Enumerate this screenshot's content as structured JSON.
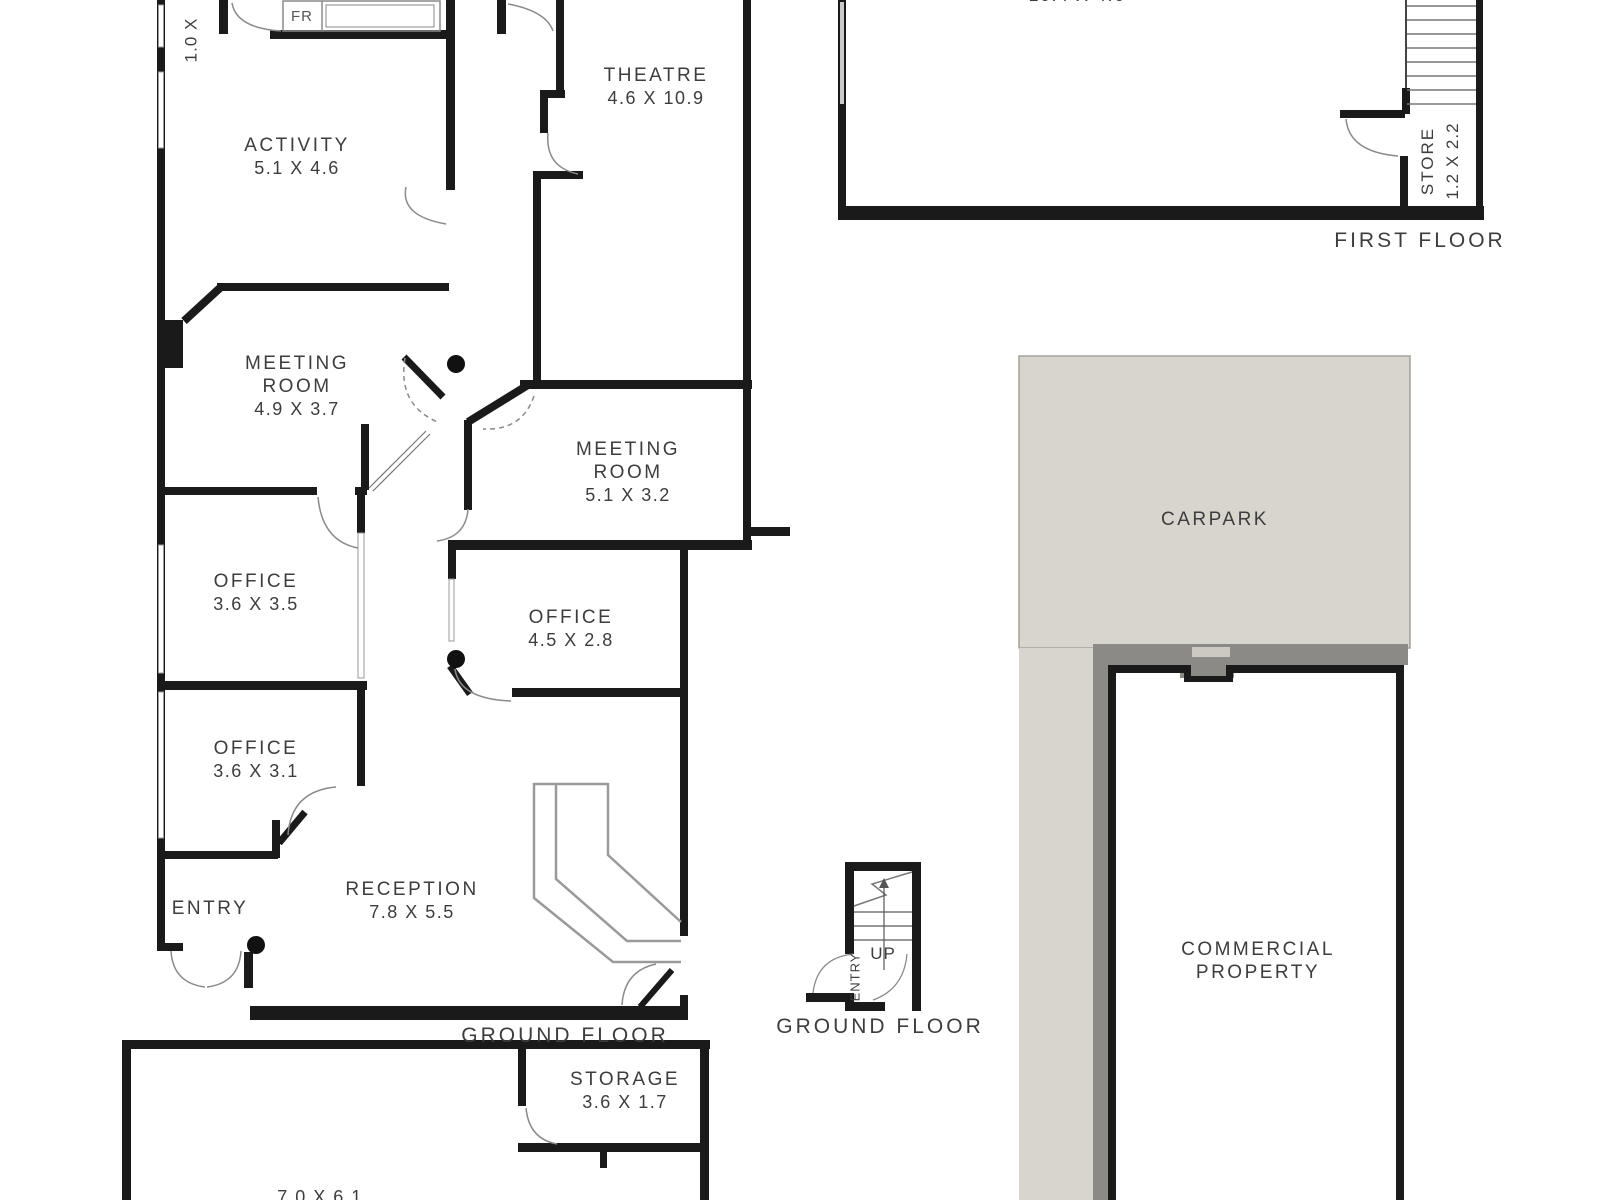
{
  "fp": {
    "ground": {
      "floor_label": "GROUND FLOOR",
      "rooms": {
        "activity": {
          "name": "ACTIVITY",
          "dims": "5.1 X 4.6"
        },
        "theatre": {
          "name": "THEATRE",
          "dims": "4.6 X 10.9"
        },
        "meeting1": {
          "name1": "MEETING",
          "name2": "ROOM",
          "dims": "4.9 X 3.7"
        },
        "meeting2": {
          "name1": "MEETING",
          "name2": "ROOM",
          "dims": "5.1 X 3.2"
        },
        "office1": {
          "name": "OFFICE",
          "dims": "3.6 X 3.5"
        },
        "office2": {
          "name": "OFFICE",
          "dims": "4.5 X 2.8"
        },
        "office3": {
          "name": "OFFICE",
          "dims": "3.6 X 3.1"
        },
        "reception": {
          "name": "RECEPTION",
          "dims": "7.8 X 5.5"
        },
        "entry": {
          "name": "ENTRY"
        },
        "small_room_dims_partial": "1.0 X",
        "fridge": "FR"
      }
    },
    "first": {
      "floor_label": "FIRST FLOOR",
      "room_dims_partial": "10.4 X 4.6",
      "store": {
        "name": "STORE",
        "dims": "1.2 X 2.2"
      }
    },
    "stairwell": {
      "up": "UP",
      "entry": "ENTRY",
      "floor_label": "GROUND FLOOR"
    },
    "site": {
      "carpark": "CARPARK",
      "commercial1": "COMMERCIAL",
      "commercial2": "PROPERTY"
    },
    "lower": {
      "storage": {
        "name": "STORAGE",
        "dims": "3.6 X 1.7"
      },
      "room_dims_partial": "7.0 X 6.1"
    },
    "colors": {
      "wall": "#1a1a1a",
      "carpark_fill": "#d8d4ce",
      "wall_band": "#8b8a86",
      "text": "#3d3d3d"
    }
  }
}
